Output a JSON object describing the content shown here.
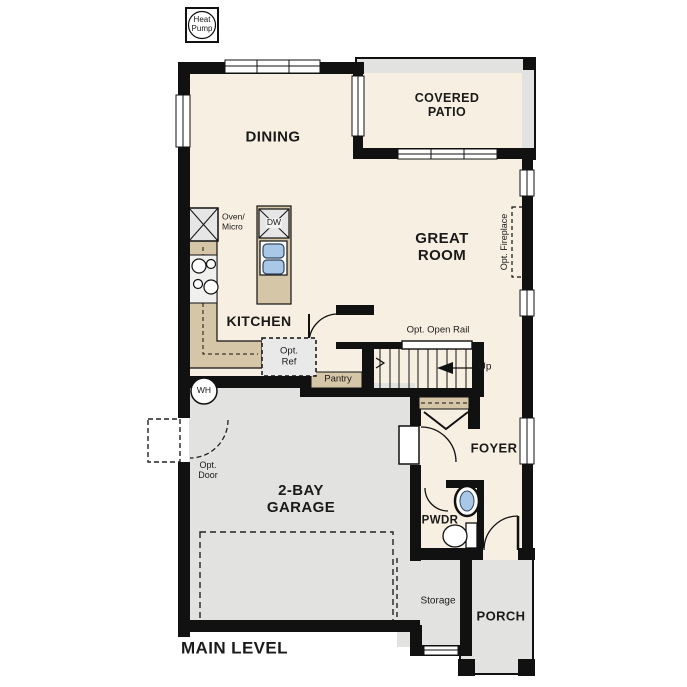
{
  "plan": {
    "title": "MAIN LEVEL",
    "rooms": {
      "dining": "DINING",
      "covered_patio": "COVERED\nPATIO",
      "great_room": "GREAT\nROOM",
      "kitchen": "KITCHEN",
      "pantry": "Pantry",
      "foyer": "FOYER",
      "pwdr": "PWDR",
      "garage": "2-BAY\nGARAGE",
      "storage": "Storage",
      "porch": "PORCH"
    },
    "annotations": {
      "heat_pump": "Heat\nPump",
      "water_heater": "WH",
      "oven_micro": "Oven/\nMicro",
      "dishwasher": "DW",
      "opt_ref": "Opt.\nRef",
      "opt_fireplace": "Opt. Fireplace",
      "opt_open_rail": "Opt. Open Rail",
      "up": "Up",
      "opt_door": "Opt.\nDoor"
    },
    "colors": {
      "interior_cream": "#f7efe2",
      "outdoor_gray": "#e2e2e0",
      "counter_tan": "#d5c6a8",
      "wall_black": "#111111",
      "fixture_blue": "#a9c7e7"
    }
  }
}
